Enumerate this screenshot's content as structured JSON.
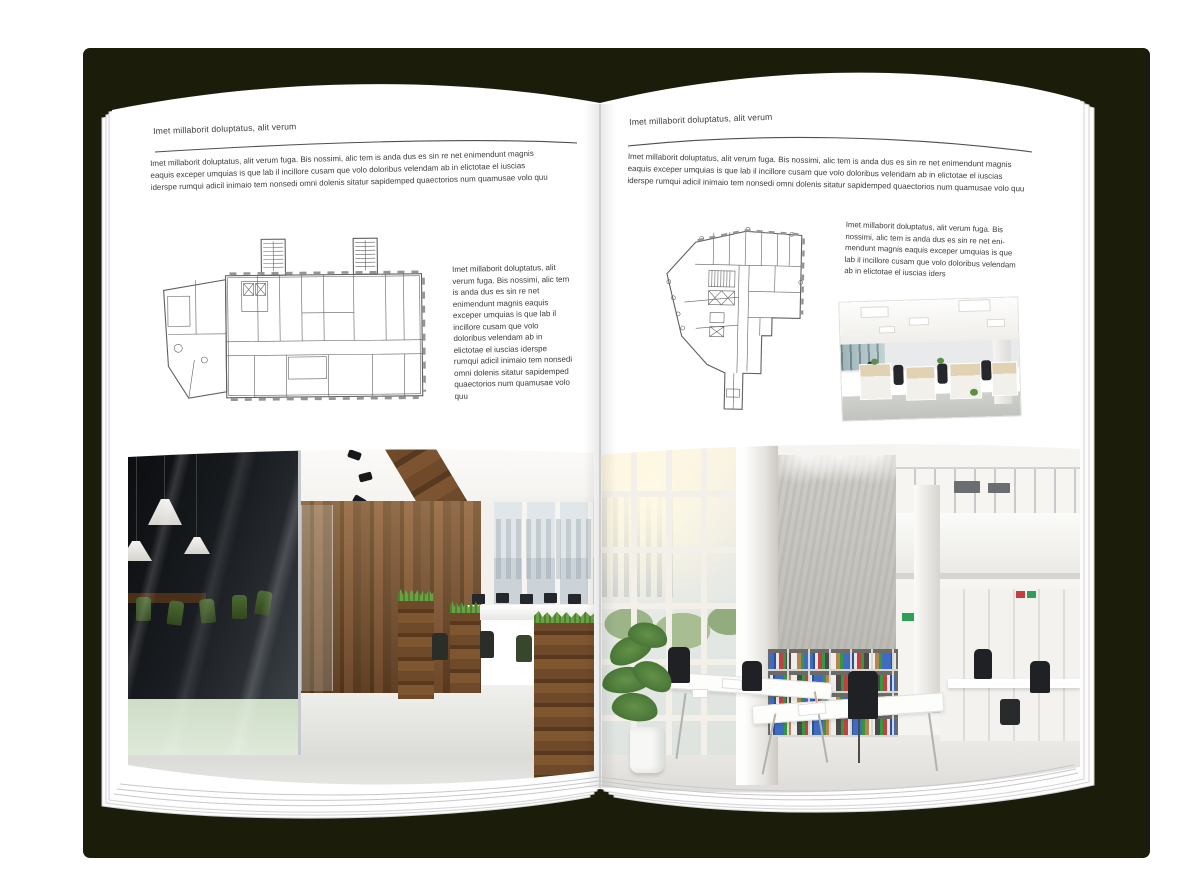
{
  "palette": {
    "cover": "#1b1d0a",
    "page": "#ffffff",
    "text": "#3c3c3c",
    "rule": "#4f4f4f",
    "spine": "#c6c6c6",
    "plan_line": "#4f4f4f",
    "wood": "#7a5230",
    "chair_green": "#4c6a33",
    "binder_blue": "#3f6cc0",
    "binder_red": "#c24040",
    "binder_green": "#35973f"
  },
  "left_page": {
    "header": "Imet millaborit doluptatus, alit verum",
    "intro": "Imet millaborit doluptatus, alit verum fuga. Bis nossimi, alic tem is anda dus es sin re net enimendunt magnis eaquis exceper umquias is que lab il incillore cusam que volo doloribus velendam ab in elictotae el iuscias iderspe rumqui adicil inimaio tem nonsedi omni dolenis sitatur sapidemped quaectorios num quamusae volo quu",
    "side_text": "Imet millaborit doluptatus, alit verum fuga. Bis nossimi, alic tem is anda dus es sin re net enimendunt magnis eaquis exceper umquias is que lab il incillore cusam que volo doloribus velendam ab in elictotae el iuscias iderspe rumqui adicil inimaio tem nonsedi omni dolenis sitatur sapidemped quaectorios num quamusae volo quu",
    "floorplan": "office-building-floor-plan",
    "photo": "loft-office-interior-with-wood-wall-and-green-chairs"
  },
  "right_page": {
    "header": "Imet millaborit doluptatus, alit verum",
    "intro": "Imet millaborit doluptatus, alit verum fuga. Bis nossimi, alic tem is anda dus es sin re net enimendunt magnis eaquis exceper umquias is que lab il incillore cusam que volo doloribus velendam ab in elictotae el iuscias iderspe rumqui adicil inimaio tem nonsedi omni dolenis sitatur sapidemped quaectorios num quamusae volo quu",
    "side_text": "Imet millaborit doluptatus, alit verum fuga. Bis nossimi, alic tem is anda dus es sin re net eni-mendunt magnis eaquis exceper umquias is que lab il incillore cusam que volo doloribus velendam ab in elictotae el iuscias iders",
    "floorplan": "irregular-office-floor-plan",
    "photo_small": "open-office-with-desk-rows",
    "photo": "bright-double-height-office-interior"
  }
}
